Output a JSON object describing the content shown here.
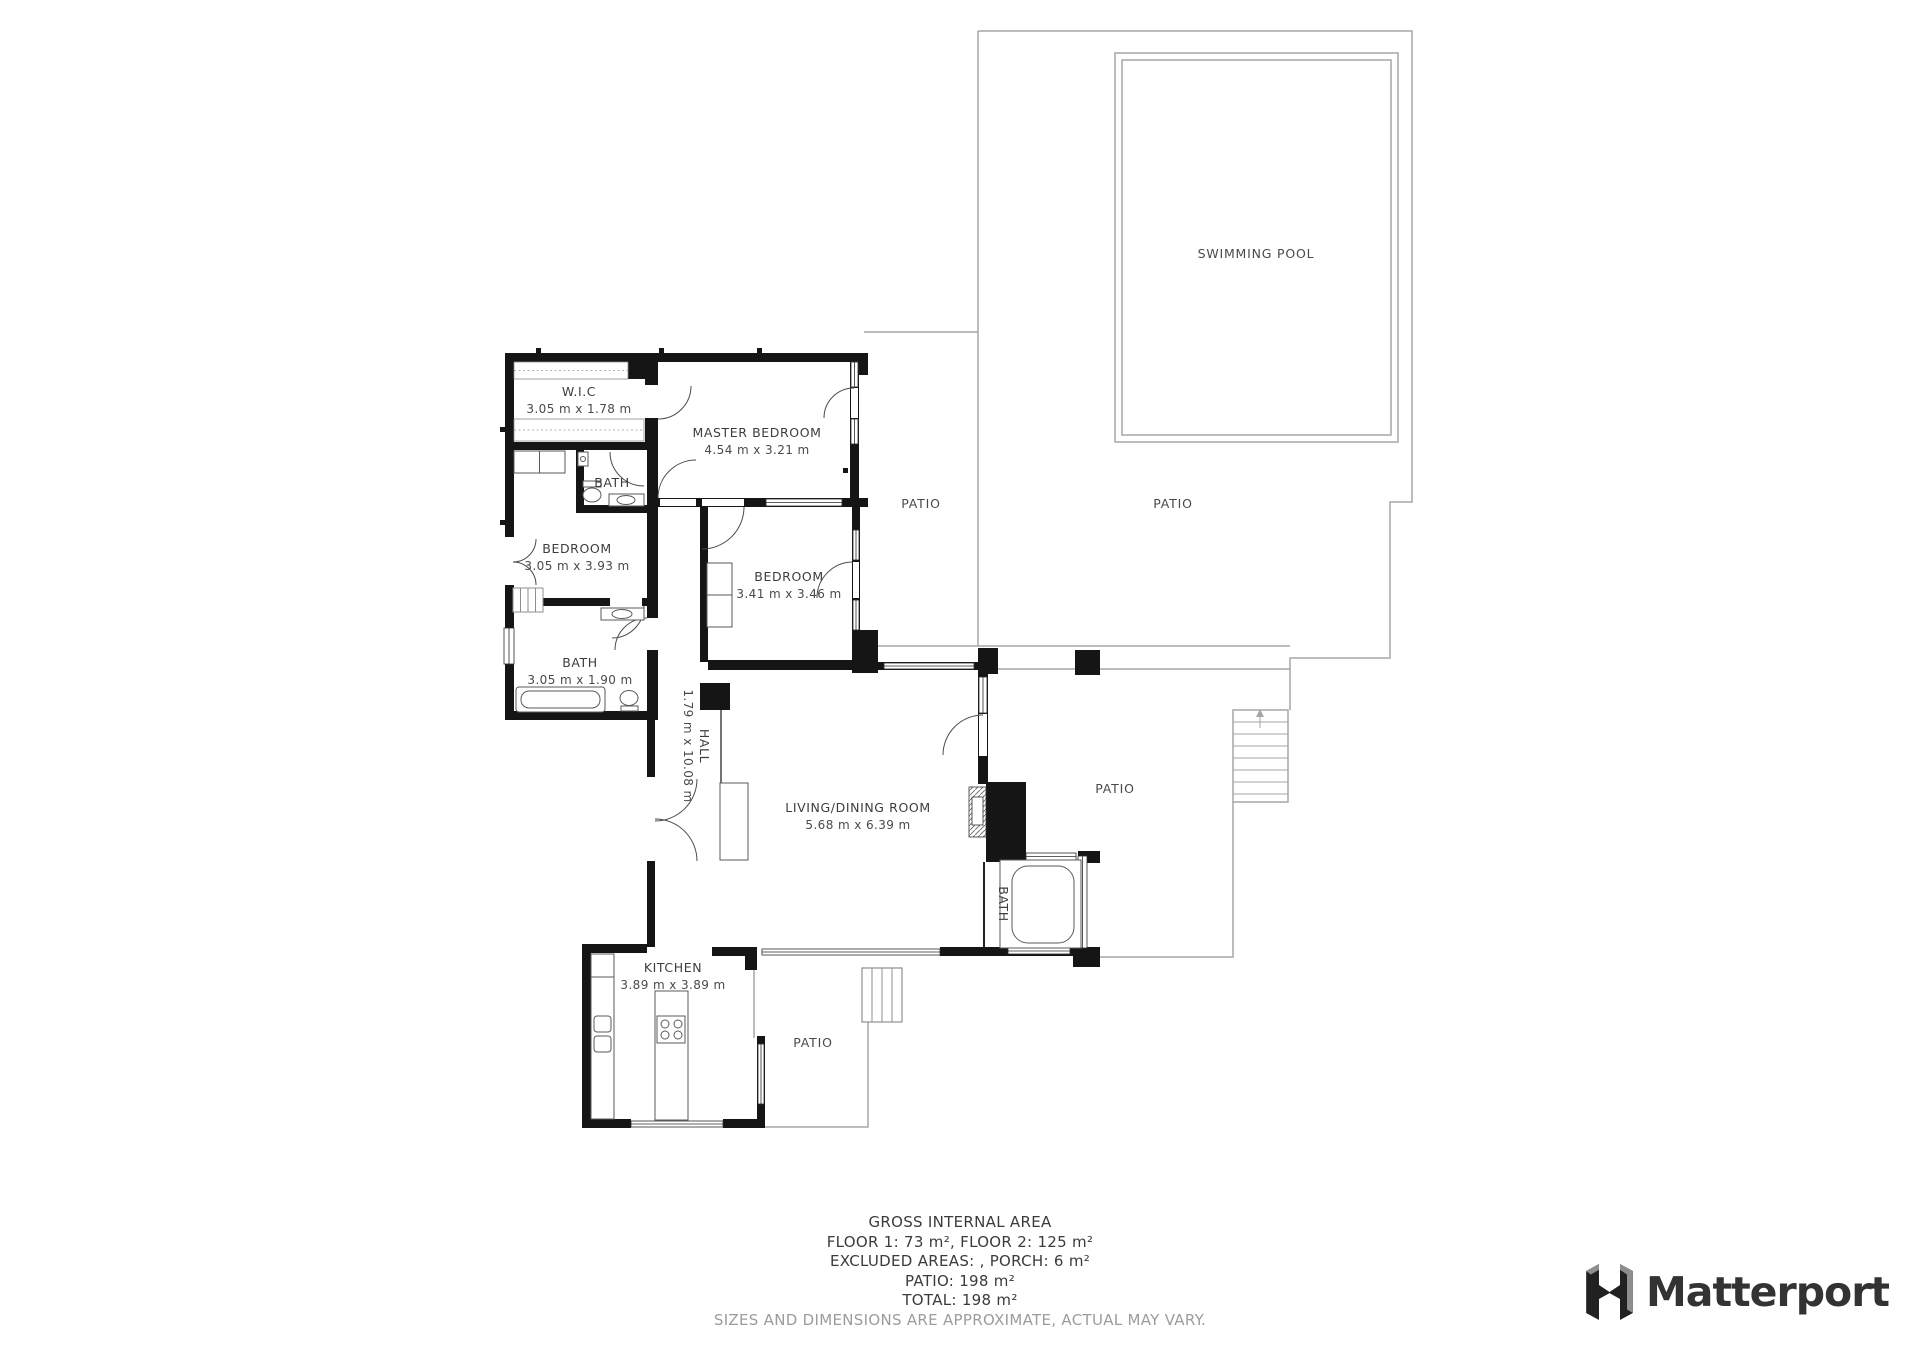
{
  "rooms": {
    "wic": {
      "name": "W.I.C",
      "dims": "3.05 m x 1.78 m"
    },
    "master_bedroom": {
      "name": "MASTER BEDROOM",
      "dims": "4.54 m x 3.21 m"
    },
    "bath_top": {
      "name": "BATH"
    },
    "bedroom_left": {
      "name": "BEDROOM",
      "dims": "3.05 m x 3.93 m"
    },
    "bath_left": {
      "name": "BATH",
      "dims": "3.05 m x 1.90 m"
    },
    "hall": {
      "name": "HALL",
      "dims": "1.79 m x 10.08 m"
    },
    "bedroom_middle": {
      "name": "BEDROOM",
      "dims": "3.41 m x 3.46 m"
    },
    "living_dining": {
      "name": "LIVING/DINING ROOM",
      "dims": "5.68 m x 6.39 m"
    },
    "kitchen": {
      "name": "KITCHEN",
      "dims": "3.89 m x 3.89 m"
    },
    "bath_lower": {
      "name": "BATH"
    }
  },
  "outdoor": {
    "swimming_pool": "SWIMMING POOL",
    "patio_upper_left": "PATIO",
    "patio_pool": "PATIO",
    "patio_middle": "PATIO",
    "patio_bottom": "PATIO"
  },
  "summary": {
    "title": "GROSS INTERNAL AREA",
    "floors": "FLOOR 1: 73 m², FLOOR 2: 125 m²",
    "excluded": "EXCLUDED AREAS: , PORCH: 6 m²",
    "patio": "PATIO: 198 m²",
    "total": "TOTAL: 198 m²",
    "disclaimer": "SIZES AND DIMENSIONS ARE APPROXIMATE, ACTUAL MAY VARY."
  },
  "branding": {
    "logo_text": "Matterport"
  },
  "colors": {
    "wall": "#151515",
    "boundary": "#a6a6a6",
    "text": "#3d3d3d",
    "logo": "#333333"
  }
}
